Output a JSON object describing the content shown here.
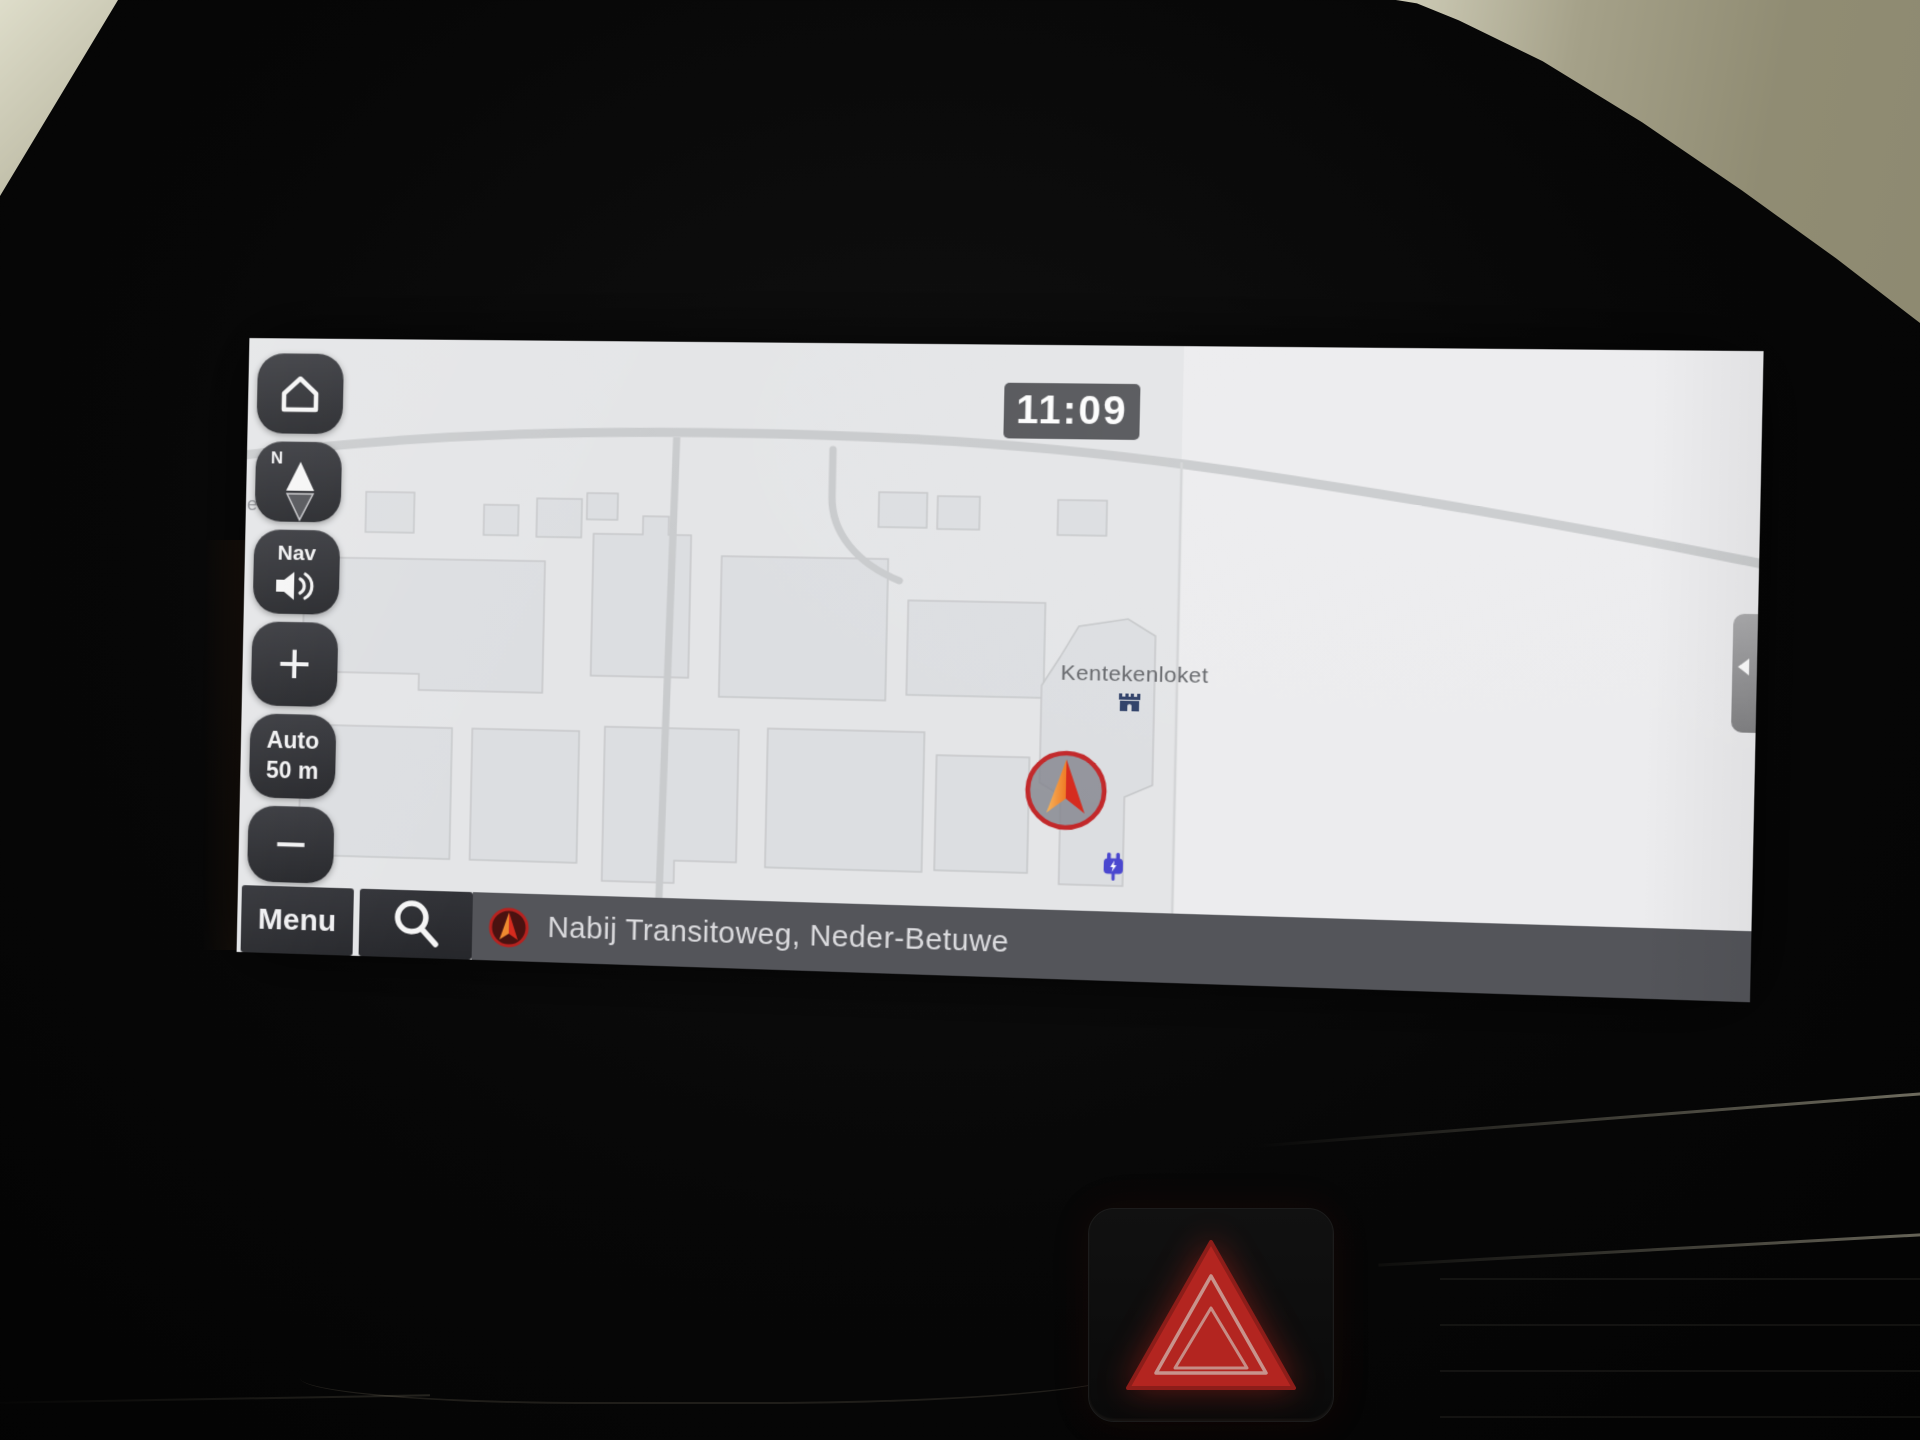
{
  "screen": {
    "clock": "11:09",
    "sidebar": {
      "home": {
        "icon": "home-icon"
      },
      "compass": {
        "cardinal": "N",
        "icon": "compass-needle-icon"
      },
      "nav_volume": {
        "label": "Nav",
        "icon": "speaker-icon"
      },
      "zoom_in": {
        "label": "+"
      },
      "scale": {
        "mode": "Auto",
        "distance": "50 m"
      },
      "zoom_out": {
        "label": "−"
      }
    },
    "bottom_bar": {
      "menu": {
        "label": "Menu"
      },
      "search": {
        "icon": "magnifier-icon"
      },
      "status": {
        "icon": "heading-arrow-icon",
        "text": "Nabij Transitoweg, Neder-Betuwe"
      }
    },
    "map": {
      "poi": {
        "label": "Kentekenloket",
        "icon": "public-building-icon"
      },
      "ev_charger": {
        "icon": "ev-charger-icon"
      },
      "position_marker": {
        "icon": "current-position-arrow-icon"
      },
      "edge_label": "e",
      "side_tab": {
        "icon": "chevron-left-icon"
      }
    },
    "colors": {
      "accent_red": "#c2282a",
      "marker_orange_start": "#f6b45c",
      "marker_orange_end": "#ef7b24",
      "marker_red": "#d62b1e",
      "poi_navy": "#2f4068",
      "ev_blue": "#4a47cf",
      "button_bg": "#2b2c30",
      "bar_bg": "#54555a",
      "map_bg": "#e9eaec",
      "time_badge_bg": "#55565a"
    }
  },
  "dashboard": {
    "hazard_button": {
      "icon": "hazard-triangle-icon"
    }
  }
}
